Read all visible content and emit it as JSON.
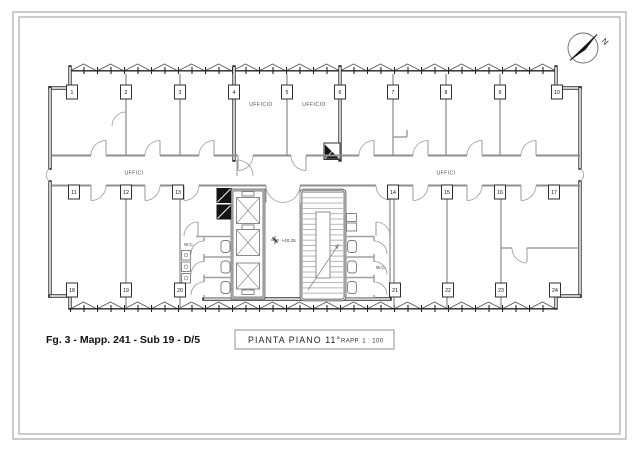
{
  "sheet": {
    "compass_label": "N",
    "footer_label": "Fg. 3 - Mapp. 241 - Sub 19 - D/5",
    "title": "PIANTA PIANO 11°",
    "scale_label": "RAPP.  1 : 100"
  },
  "plan": {
    "level_marker": "+40.25",
    "labels": {
      "corridor_left": "UFFICI",
      "corridor_right": "UFFICI",
      "office_left": "UFFICIO",
      "office_right": "UFFICIO",
      "wc_left": "W.C.",
      "wc_right": "W.C."
    },
    "room_numbers": [
      "1",
      "2",
      "3",
      "4",
      "5",
      "6",
      "7",
      "8",
      "9",
      "10",
      "11",
      "12",
      "13",
      "14",
      "15",
      "16",
      "17",
      "18",
      "19",
      "20",
      "21",
      "22",
      "23",
      "24"
    ]
  },
  "colors": {
    "paper": "#ffffff",
    "wall": "#2f2f2f",
    "partition": "#a0a0a0",
    "detail_line": "#8a8a8a",
    "shaft_fill": "#141414",
    "text": "#3d3d3d"
  }
}
